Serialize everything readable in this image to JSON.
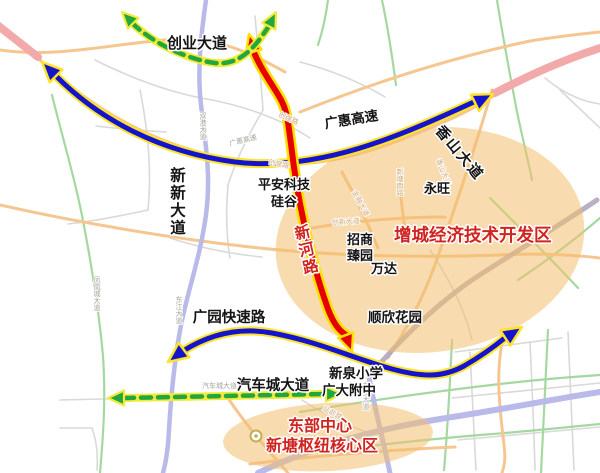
{
  "map": {
    "type": "schematic-road-map",
    "colors": {
      "arrow_blue": "#1414cc",
      "arrow_red": "#e60000",
      "arrow_green": "#22a63e",
      "arrow_casing_yellow": "#ffe329",
      "zone_fill_orange": "#f2bf6d",
      "zone_text_red": "#cf2420",
      "minor_road_orange": "#f6c690",
      "minor_road_green": "#a5d8a0",
      "minor_road_purple": "#b9b9ea",
      "minor_road_pink": "#f2a9a9",
      "minor_road_gray": "#d9d9d9"
    },
    "labels": {
      "chuangye_avenue": "创业大道",
      "guanghui_expressway": "广惠高速",
      "xinxin_avenue": "新新大道",
      "xiangshan_avenue": "香山大道",
      "yongwang": "永旺",
      "pingan_line1": "平安科技",
      "pingan_line2": "硅谷",
      "xinhe_road": "新河路",
      "zengcheng_zone": "增城经济技术开发区",
      "zhaoshang_line1": "招商",
      "zhaoshang_line2": "臻园",
      "wanda": "万达",
      "shunxin_garden": "顺欣花园",
      "guangyuan_expressway": "广园快速路",
      "xinquan_school": "新泉小学",
      "guangda_school": "广大附中",
      "qichecheng_avenue": "汽车城大道",
      "dongbu_line1": "东部中心",
      "dongbu_line2": "新塘枢纽核心区"
    },
    "minor_labels": {
      "shuanggang": "双港大道",
      "fenghuangcheng": "凤凰城大道",
      "dongjiang": "东江大道",
      "dongbu_rd": "东步大道",
      "chuangqiang": "创强路",
      "chuangyu": "创誉路",
      "jinrong": "金融大道",
      "chuangxin": "创新大道",
      "xiangshan_small": "香山大道",
      "xintang_south": "新塘南路",
      "qichecheng_small": "汽车城大道",
      "zhanqian": "站前路",
      "guanghui_small": "广惠高速"
    }
  }
}
